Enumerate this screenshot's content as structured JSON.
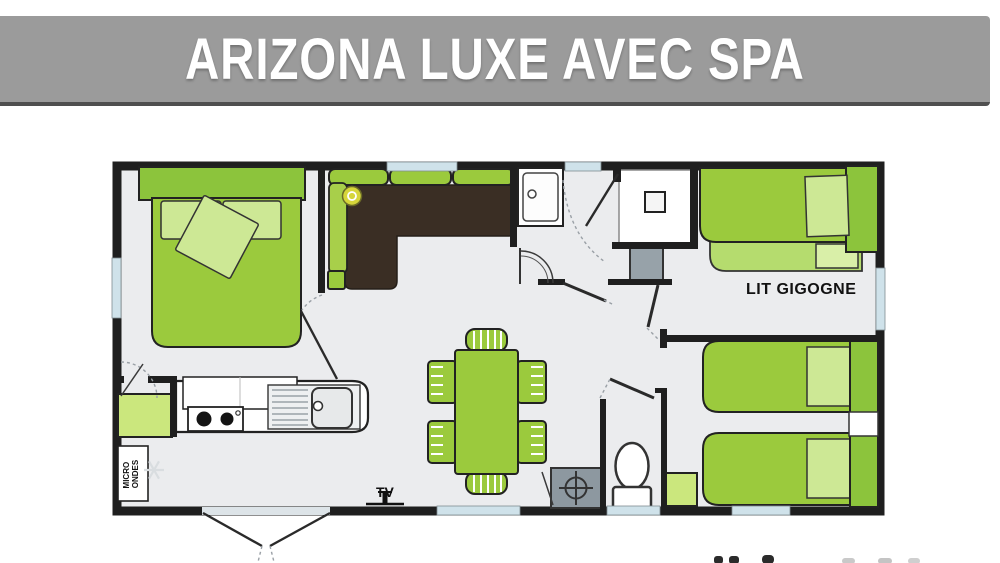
{
  "header": {
    "title": "ARIZONA LUXE AVEC SPA"
  },
  "plan": {
    "labels": {
      "trundle_bed": "LIT GIGOGNE",
      "tv": "TV",
      "microwave_line1": "MICRO",
      "microwave_line2": "ONDES"
    },
    "palette": {
      "banner_gray": "#9B9B9B",
      "furniture_green": "#9BCA3D",
      "furniture_green_dark": "#8CC43C",
      "pillow_green": "#CDE895",
      "trundle_green": "#B5DC6E",
      "accent_light_green": "#CBE77D",
      "sofa_brown": "#3A2E24",
      "lamp_yellow": "#D6D53A",
      "appliance_gray": "#97A2A9",
      "window_blue": "#CFE2EA",
      "wall_black": "#1F1F1F",
      "floor_gray": "#EBECEE"
    }
  }
}
